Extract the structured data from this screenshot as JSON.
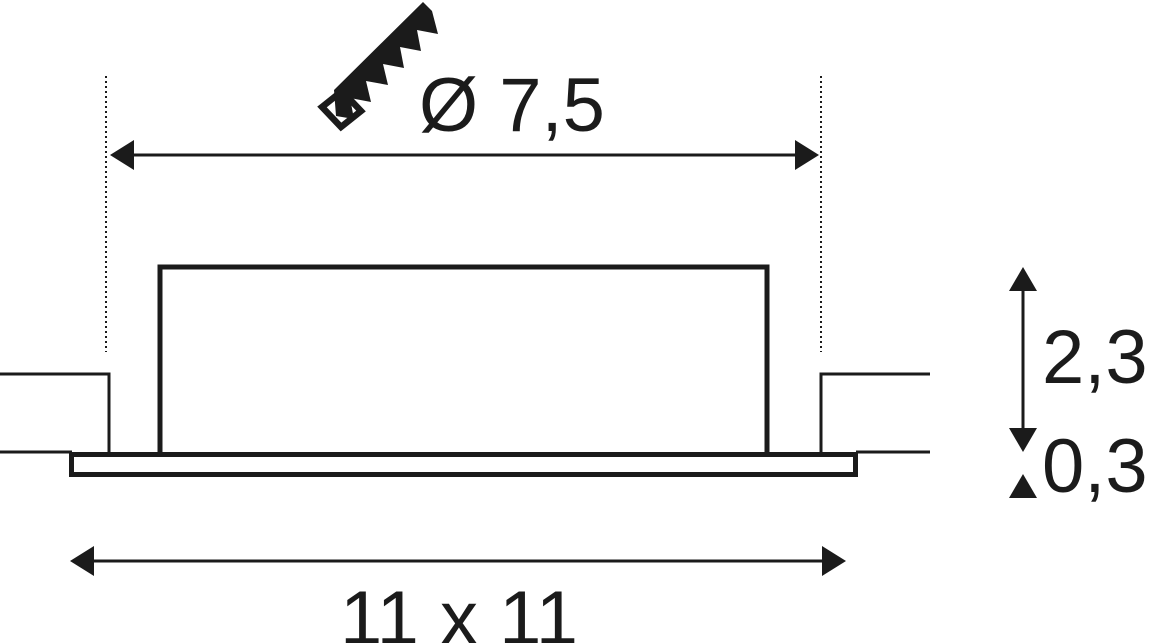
{
  "labels": {
    "cutout_diameter": "Ø 7,5",
    "recess_height": "2,3",
    "trim_thickness": "0,3",
    "footprint": "11 x 11"
  },
  "icons": {
    "cutout_tool": "saw-icon"
  },
  "colors": {
    "ink": "#1b1b1b",
    "bg": "#ffffff"
  }
}
